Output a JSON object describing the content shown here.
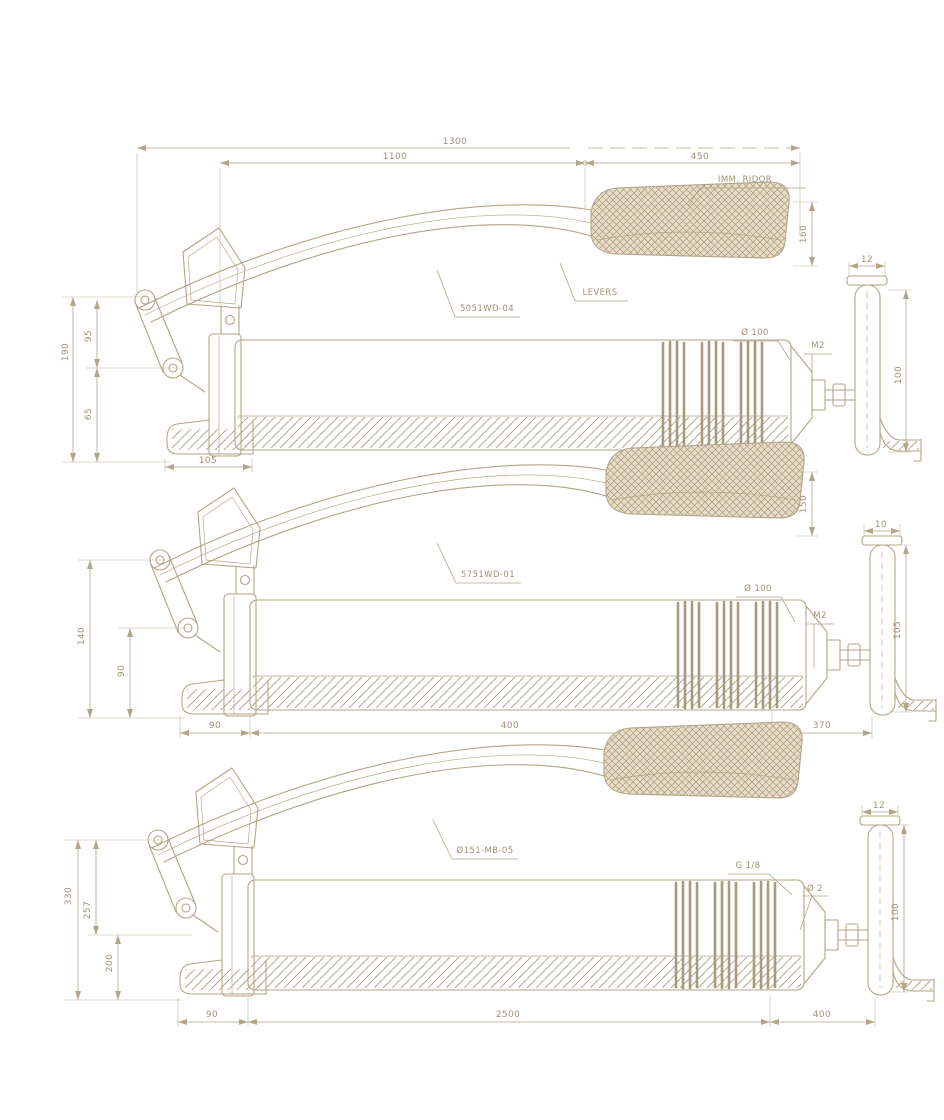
{
  "drawing": {
    "kind": "technical-drawing",
    "subject": "lever grease gun, three stacked side views with dimensions",
    "colors": {
      "background": "#ffffff",
      "line": "#b3a58a",
      "text": "#9f927a"
    },
    "views": [
      {
        "name": "top view",
        "dims": {
          "overall": "1300",
          "body": "1100",
          "grip_len": "450",
          "grip_height": "160",
          "left_total": "190",
          "left_upper": "95",
          "left_lower": "65",
          "foot": "105",
          "handle_top": "12",
          "handle_height": "100",
          "barrel_dia": "Ø 100",
          "nozzle": "M2"
        },
        "callouts": {
          "grip": "IMM. RIDOR",
          "lever": "LEVERS",
          "part": "5051WD-04"
        }
      },
      {
        "name": "middle view",
        "dims": {
          "grip_height": "150",
          "left_total": "140",
          "left_lower": "90",
          "foot": "90",
          "barrel_len": "400",
          "tail": "370",
          "handle_top": "10",
          "handle_height": "105",
          "barrel_dia": "Ø 100",
          "nozzle": "M2"
        },
        "callouts": {
          "part": "5751WD-01"
        }
      },
      {
        "name": "bottom view",
        "dims": {
          "left_total": "330",
          "left_mid": "257",
          "left_lower": "200",
          "foot": "90",
          "barrel_len": "2500",
          "tail": "400",
          "handle_top": "12",
          "handle_height": "100",
          "thread": "G 1/8",
          "nozzle": "Ø 2"
        },
        "callouts": {
          "part": "Ø151-MB-05"
        }
      }
    ]
  }
}
